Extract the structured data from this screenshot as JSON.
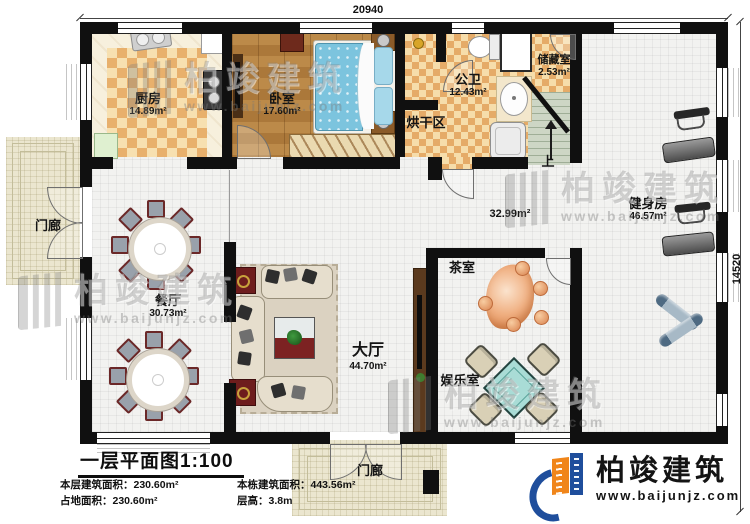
{
  "dimensions": {
    "top": "20940",
    "right": "14520"
  },
  "rooms": {
    "kitchen": {
      "label": "厨房",
      "area": "14.89m²"
    },
    "bedroom": {
      "label": "卧室",
      "area": "17.60m²"
    },
    "bathroom": {
      "label": "公卫",
      "area": "12.43m²"
    },
    "storage": {
      "label": "储藏室",
      "area": "2.53m²"
    },
    "drying": {
      "label": "烘干区"
    },
    "gym": {
      "label": "健身房",
      "area": "46.57m²"
    },
    "corridor": {
      "area": "32.99m²"
    },
    "tea": {
      "label": "茶室"
    },
    "entertainment": {
      "label": "娱乐室"
    },
    "hall": {
      "label": "大厅",
      "area": "44.70m²"
    },
    "dining": {
      "label": "餐厅",
      "area": "30.73m²"
    },
    "porch_left": {
      "label": "门廊"
    },
    "porch_bottom": {
      "label": "门廊"
    }
  },
  "stairs": {
    "up": "上"
  },
  "title_block": {
    "title": "一层平面图1:100",
    "stats": [
      {
        "label": "本层建筑面积：",
        "value": "230.60m²"
      },
      {
        "label": "本栋建筑面积：",
        "value": "443.56m²"
      },
      {
        "label": "占地面积：",
        "value": "230.60m²"
      },
      {
        "label": "层高：",
        "value": "3.8m"
      }
    ]
  },
  "brand": {
    "name": "柏竣建筑",
    "url": "www.baijunjz.com",
    "accent_blue": "#1f4e9c",
    "accent_orange": "#f08519"
  },
  "watermark": {
    "name": "柏竣建筑",
    "url": "www.baijunjz.com"
  }
}
